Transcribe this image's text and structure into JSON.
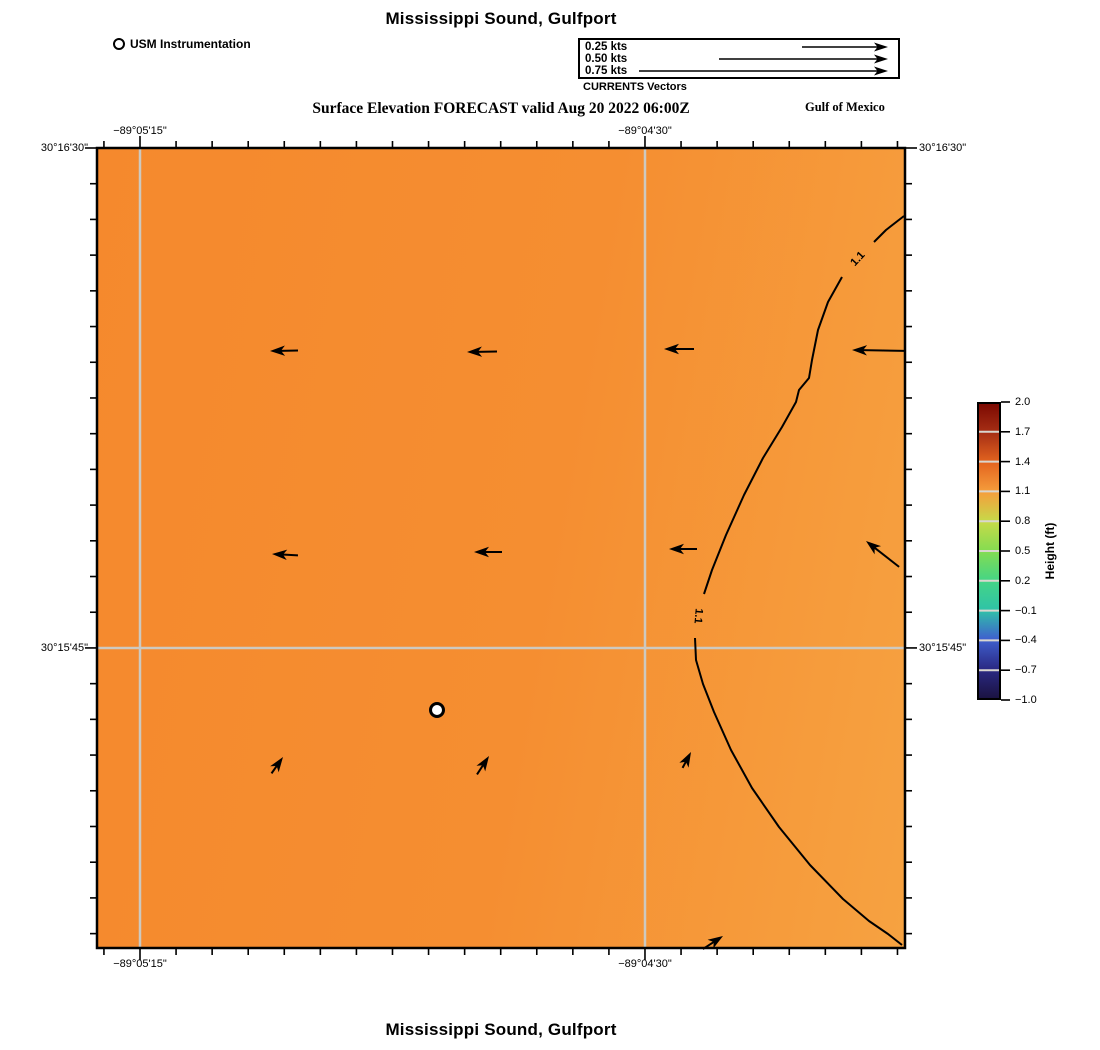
{
  "title": {
    "top": "Mississippi Sound, Gulfport",
    "bottom": "Mississippi Sound, Gulfport"
  },
  "header": {
    "instrument_legend": "USM Instrumentation",
    "vector_legend": {
      "entries": [
        {
          "label": "0.25 kts",
          "tail_px": 86
        },
        {
          "label": "0.50 kts",
          "tail_px": 169
        },
        {
          "label": "0.75 kts",
          "tail_px": 249
        }
      ],
      "caption": "CURRENTS Vectors"
    },
    "subtitle": "Surface Elevation FORECAST valid Aug 20 2022 06:00Z",
    "region_label": "Gulf of Mexico"
  },
  "axes": {
    "lon_ticks": [
      {
        "label": "−89°05'15\"",
        "x": 140
      },
      {
        "label": "−89°04'30\"",
        "x": 645
      }
    ],
    "lat_ticks": [
      {
        "label": "30°16'30\"",
        "y": 148
      },
      {
        "label": "30°15'45\"",
        "y": 648
      }
    ]
  },
  "colorbar": {
    "label": "Height (ft)",
    "ticks": [
      "2.0",
      "1.7",
      "1.4",
      "1.1",
      "0.8",
      "0.5",
      "0.2",
      "−0.1",
      "−0.4",
      "−0.7",
      "−1.0"
    ],
    "colors_top_to_bottom": [
      "#7c0a02",
      "#a83015",
      "#e4651f",
      "#f59e3c",
      "#c6da49",
      "#84dc51",
      "#45d585",
      "#2fc3a7",
      "#3f60ce",
      "#2b2a85",
      "#1b1342"
    ]
  },
  "colors": {
    "map_left": "#f5892d",
    "map_mid": "#f58e31",
    "map_right": "#f6a241",
    "gridline": "#cdc9c0",
    "contour": "#000000"
  },
  "chart_data": {
    "type": "heatmap",
    "title": "Mississippi Sound, Gulfport",
    "subtitle": "Surface Elevation FORECAST valid Aug 20 2022 06:00Z",
    "variable": "Surface Elevation (ft)",
    "valid_time": "Aug 20 2022 06:00Z",
    "x_ticks": [
      "−89°05'15\"",
      "−89°04'30\""
    ],
    "y_ticks": [
      "30°16'30\"",
      "30°15'45\""
    ],
    "colorbar": {
      "label": "Height (ft)",
      "min": -1.0,
      "max": 2.0,
      "tick_values": [
        2.0,
        1.7,
        1.4,
        1.1,
        0.8,
        0.5,
        0.2,
        -0.1,
        -0.4,
        -0.7,
        -1.0
      ]
    },
    "contour_levels_shown": [
      1.1
    ],
    "field_summary": "Elevation roughly 1.15–1.3 ft over most of the domain, decreasing to 1.1 ft along a contour near the eastern edge",
    "vector_legend_kts": [
      0.25,
      0.5,
      0.75
    ],
    "current_vectors": [
      {
        "x_frac": 0.21,
        "y_frac": 0.25,
        "bearing": "W"
      },
      {
        "x_frac": 0.46,
        "y_frac": 0.26,
        "bearing": "W"
      },
      {
        "x_frac": 0.7,
        "y_frac": 0.25,
        "bearing": "W"
      },
      {
        "x_frac": 0.93,
        "y_frac": 0.25,
        "bearing": "W"
      },
      {
        "x_frac": 0.22,
        "y_frac": 0.51,
        "bearing": "W"
      },
      {
        "x_frac": 0.47,
        "y_frac": 0.5,
        "bearing": "W"
      },
      {
        "x_frac": 0.71,
        "y_frac": 0.5,
        "bearing": "W"
      },
      {
        "x_frac": 0.95,
        "y_frac": 0.49,
        "bearing": "NW"
      },
      {
        "x_frac": 0.23,
        "y_frac": 0.76,
        "bearing": "NE"
      },
      {
        "x_frac": 0.49,
        "y_frac": 0.76,
        "bearing": "NE"
      },
      {
        "x_frac": 0.73,
        "y_frac": 0.76,
        "bearing": "NE"
      },
      {
        "x_frac": 0.78,
        "y_frac": 0.99,
        "bearing": "NE"
      }
    ],
    "instrument_marker": {
      "label": "USM Instrumentation",
      "x_frac": 0.42,
      "y_frac": 0.7
    }
  },
  "draw": {
    "map": {
      "left": 97,
      "top": 148,
      "width": 808,
      "height": 800
    },
    "grid": {
      "xs": [
        140,
        645
      ],
      "ys": [
        648
      ]
    },
    "tick": {
      "x_major": [
        140,
        645
      ],
      "x_step": 36.07,
      "y_major": [
        148,
        648
      ],
      "y_step": 35.71,
      "minor_len": 7,
      "major_len": 12
    },
    "contour": {
      "label": "1.1",
      "segments": [
        "M904,216 L886,230 L874,242",
        "M842,277 L828,302 L818,330 L812,360 L809,378 L799,390 L796,402 L782,427 L763,458 L744,495 L726,535 L712,570 L704,594",
        "M695,638 L696,660 L703,684 L714,712 L731,750 L752,788 L779,827 L810,865 L843,899 L869,921 L888,934 L902,945"
      ],
      "labels": [
        {
          "x": 858,
          "y": 259,
          "rot": -47
        },
        {
          "x": 698,
          "y": 616,
          "rot": 95
        }
      ]
    },
    "vectors": [
      {
        "x": 270,
        "y": 351,
        "rot": 179,
        "len": 28
      },
      {
        "x": 467,
        "y": 352,
        "rot": 179,
        "len": 30
      },
      {
        "x": 664,
        "y": 349,
        "rot": 180,
        "len": 30
      },
      {
        "x": 852,
        "y": 350,
        "rot": 181,
        "len": 52
      },
      {
        "x": 272,
        "y": 554,
        "rot": 183,
        "len": 26
      },
      {
        "x": 474,
        "y": 552,
        "rot": 180,
        "len": 28
      },
      {
        "x": 669,
        "y": 549,
        "rot": 180,
        "len": 28
      },
      {
        "x": 866,
        "y": 541,
        "rot": -142,
        "len": 42
      },
      {
        "x": 283,
        "y": 757,
        "rot": -55,
        "len": 20
      },
      {
        "x": 489,
        "y": 756,
        "rot": -57,
        "len": 22
      },
      {
        "x": 691,
        "y": 752,
        "rot": -62,
        "len": 18
      },
      {
        "x": 723,
        "y": 936,
        "rot": -33,
        "len": 24
      }
    ],
    "marker": {
      "x": 437,
      "y": 710,
      "r": 6.5
    },
    "legend_arrows": {
      "tip_x": 888,
      "rows_y": [
        47,
        59,
        71
      ]
    },
    "colorbar_geom": {
      "left": 977,
      "top": 402,
      "width": 24,
      "height": 298
    }
  }
}
